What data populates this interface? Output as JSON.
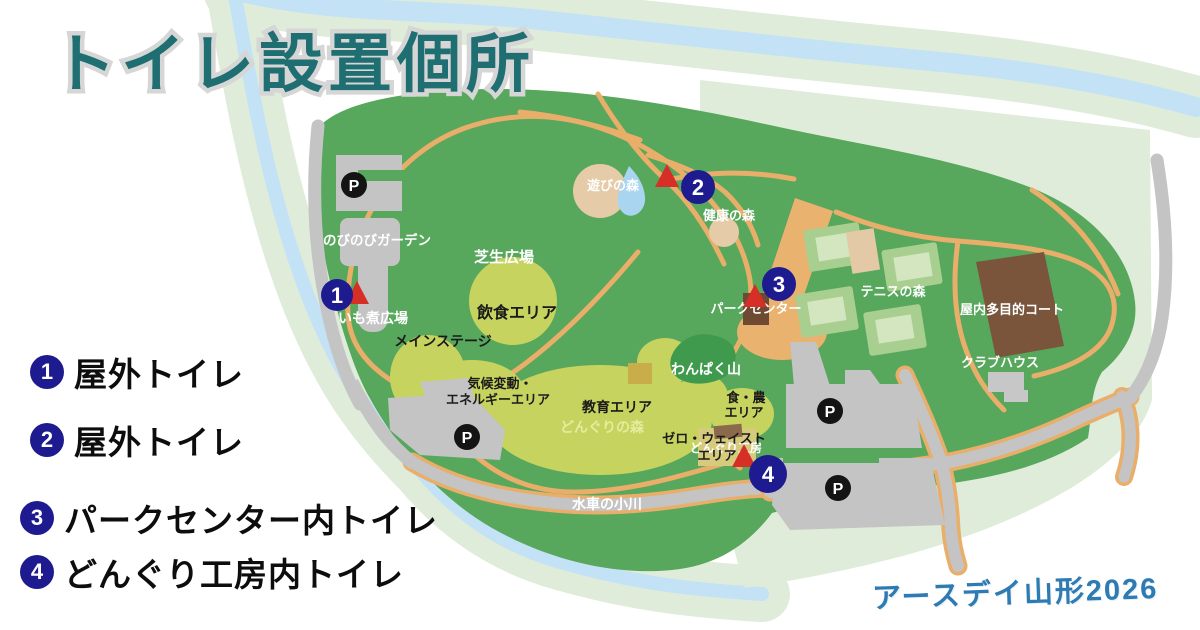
{
  "page": {
    "title": "トイレ設置個所",
    "credit": "アースデイ山形2026"
  },
  "colors": {
    "title_teal": "#1f6e72",
    "title_outline": "#d6d6d6",
    "marker_navy": "#1e1a8f",
    "marker_red": "#d62f28",
    "park_green": "#57a75c",
    "pale_green": "#dfecd9",
    "river_blue": "#c4e2f6",
    "lawn_yellow": "#c7d35f",
    "path_orange": "#e9ae6a",
    "road_gray": "#c4c4c4",
    "building_brown": "#7a553b",
    "dark_hill_green": "#3f9a4e",
    "credit_blue": "#2e7ab2"
  },
  "legend": {
    "items": [
      {
        "number": "1",
        "label": "屋外トイレ"
      },
      {
        "number": "2",
        "label": "屋外トイレ"
      },
      {
        "number": "3",
        "label": "パークセンター内トイレ"
      },
      {
        "number": "4",
        "label": "どんぐり工房内トイレ"
      }
    ]
  },
  "map": {
    "parking_label": "P",
    "markers": [
      {
        "number": "1"
      },
      {
        "number": "2"
      },
      {
        "number": "3"
      },
      {
        "number": "4"
      }
    ],
    "labels": {
      "nobinobi_garden": "のびのびガーデン",
      "shibafu_hiroba": "芝生広場",
      "asobi_no_mori": "遊びの森",
      "kenko_no_mori": "健康の森",
      "imoni_hiroba": "いも煮広場",
      "main_stage": "メインステージ",
      "inshoku_area": "飲食エリア",
      "kiko_hendo_energy": [
        "気候変動・",
        "エネルギーエリア"
      ],
      "kyoiku_area": "教育エリア",
      "donguri_no_mori": "どんぐりの森",
      "wanpaku_yama": "わんぱく山",
      "shoku_no_area": [
        "食・農",
        "エリア"
      ],
      "donguri_kobo": "どんぐり工房",
      "zero_waste_area": [
        "ゼロ・ウェイスト",
        "エリア"
      ],
      "park_center": "パークセンター",
      "tennis_no_mori": "テニスの森",
      "okunai_tamokuteki_court": "屋内多目的コート",
      "club_house": "クラブハウス",
      "suisha_no_ogawa": "水車の小川"
    }
  }
}
